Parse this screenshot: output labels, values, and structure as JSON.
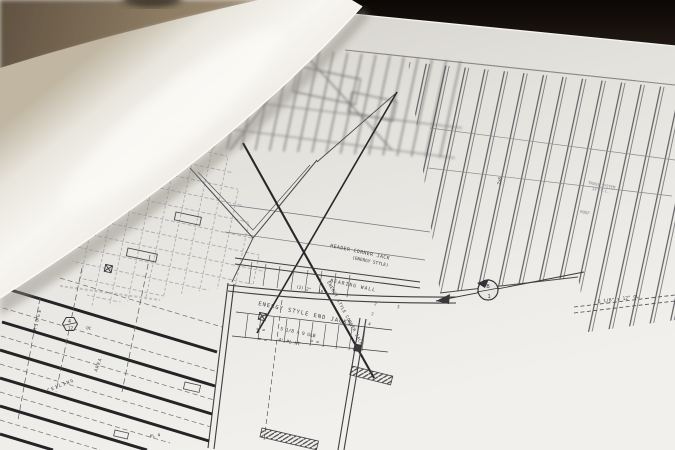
{
  "colors": {
    "background_dark": "#0b0705",
    "wood_dark": "#5f5140",
    "wood_light": "#a3927a",
    "roll_shadow": "#c0b6a2",
    "roll_highlight": "#f8f6f1",
    "sheet_dark": "#cfccc6",
    "sheet_light": "#f1f0ed",
    "ink": "#3f3e41",
    "ink_heavy": "#28272a",
    "ink_light": "#77767a"
  },
  "annotations": {
    "header_jack_1": "HEADER CORNER JACK",
    "header_jack_2": "(ENERGY STYLE)",
    "bearing_wall": "BEARING WALL",
    "qty_2x": "(2) 2\"",
    "dim_10": "10'",
    "end_jacks": "ENERGY STYLE END JACKS",
    "corner_jacks_diag": "ENERGY STYLE CORNER JACK",
    "glb_beam": "5 1/8 x 9 GLB",
    "plate_height": "4' PL HT",
    "equals_a": "= =",
    "equals_b": "= =",
    "equals_c": "= =",
    "gl_beam": "5 1/8\" x 12\" GL",
    "truss_note_1": "TRUSS SYSTEM",
    "truss_note_2": "24\" O.C.",
    "roof_label": "ROOF",
    "joist_size": "2x6",
    "section_letter": "B",
    "section_number": "1",
    "pitch_rise": "4",
    "pitch_run": "12",
    "oc_label": "OC",
    "ridge_label": "RIDGE",
    "ceiling_label": "CEILING",
    "area_label": "AREA",
    "plate_4": "PL 4",
    "num_a": "2",
    "num_b": "2",
    "num_c": "4",
    "num_d": "5"
  }
}
